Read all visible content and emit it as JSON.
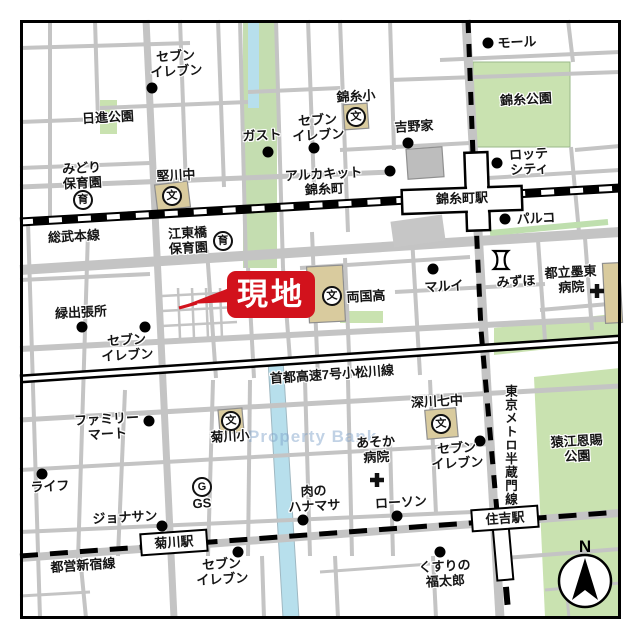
{
  "site": {
    "label": "現地"
  },
  "watermark": "Property Bank",
  "compass": {
    "north": "N"
  },
  "colors": {
    "site_red": "#d2121c",
    "park_green": "#c9e2b0",
    "river_blue": "#b7dfec",
    "road_gray": "#c4c4c4",
    "building_tan": "#d9cb9e",
    "building_gray": "#bdbdbd"
  },
  "rails": {
    "sobu": "総武本線",
    "expressway": "首都高速7号小松川線",
    "shinjuku": "都営新宿線",
    "hanzomon": "東京メトロ半蔵門線"
  },
  "stations": {
    "kinshicho": "錦糸町駅",
    "kikukawa": "菊川駅",
    "sumiyoshi": "住吉駅"
  },
  "parks": {
    "nisshin": "日進公園",
    "kinshi": "錦糸公園",
    "sarue": "猿江恩賜\n公園"
  },
  "icons": {
    "school": "文",
    "nursery": "育",
    "gas": "G"
  },
  "pois": [
    {
      "label": "セブン\nイレブン"
    },
    {
      "label": "みどり\n保育園"
    },
    {
      "label": "堅川中"
    },
    {
      "label": "ガスト"
    },
    {
      "label": "セブン\nイレブン"
    },
    {
      "label": "錦糸小"
    },
    {
      "label": "吉野家"
    },
    {
      "label": "モール"
    },
    {
      "label": "アルカキット\n錦糸町"
    },
    {
      "label": "ロッテ\nシティ"
    },
    {
      "label": "パルコ"
    },
    {
      "label": "江東橋\n保育園"
    },
    {
      "label": "両国高"
    },
    {
      "label": "マルイ"
    },
    {
      "label": "みずほ"
    },
    {
      "label": "都立墨東\n病院"
    },
    {
      "label": "緑出張所"
    },
    {
      "label": "セブン\nイレブン"
    },
    {
      "label": "ファミリー\nマート"
    },
    {
      "label": "菊川小"
    },
    {
      "label": "ライフ"
    },
    {
      "label": "GS"
    },
    {
      "label": "ジョナサン"
    },
    {
      "label": "肉の\nハナマサ"
    },
    {
      "label": "ローソン"
    },
    {
      "label": "あそか\n病院"
    },
    {
      "label": "セブン\nイレブン"
    },
    {
      "label": "深川七中"
    },
    {
      "label": "セブン\nイレブン"
    },
    {
      "label": "くすりの\n福太郎"
    }
  ]
}
